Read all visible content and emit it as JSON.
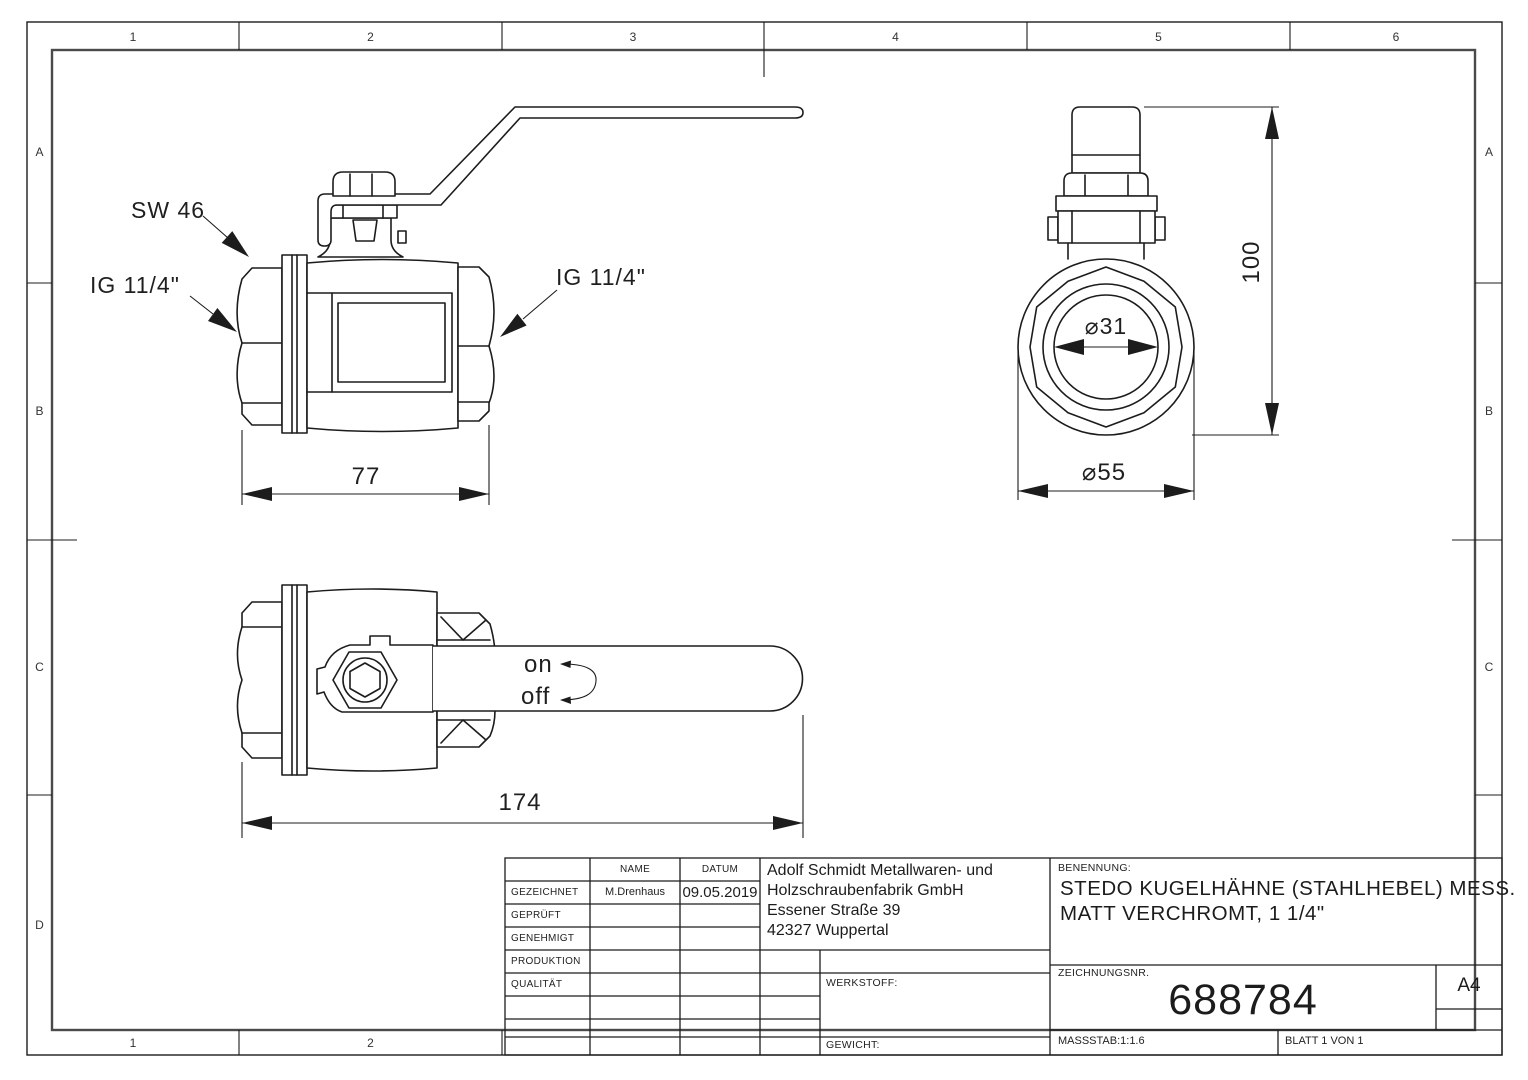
{
  "ruler": {
    "top": [
      "1",
      "2",
      "3",
      "4",
      "5",
      "6"
    ],
    "bottom": [
      "1",
      "2"
    ],
    "left": [
      "A",
      "B",
      "C",
      "D"
    ],
    "right": [
      "A",
      "B",
      "C"
    ]
  },
  "front_view": {
    "wrench_label": "SW 46",
    "thread_label_left": "IG 11/4\"",
    "thread_label_right": "IG 11/4\"",
    "width_dim": "77"
  },
  "end_view": {
    "height_dim": "100",
    "bore_dim": "⌀31",
    "outer_dim": "⌀55"
  },
  "top_view": {
    "length_dim": "174",
    "on_label": "on",
    "off_label": "off"
  },
  "title_block": {
    "name_header": "NAME",
    "date_header": "DATUM",
    "row_labels": {
      "drawn": "GEZEICHNET",
      "checked": "GEPRÜFT",
      "approved": "GENEHMIGT",
      "production": "PRODUKTION",
      "quality": "QUALITÄT"
    },
    "drawn_name": "M.Drenhaus",
    "drawn_date": "09.05.2019",
    "company": [
      "Adolf Schmidt Metallwaren- und",
      "Holzschraubenfabrik GmbH",
      "Essener Straße 39",
      "42327 Wuppertal"
    ],
    "material_label": "WERKSTOFF:",
    "weight_label": "GEWICHT:",
    "title_label": "BENENNUNG:",
    "title_lines": [
      "STEDO KUGELHÄHNE (STAHLHEBEL) MESS.",
      "MATT VERCHROMT, 1 1/4\""
    ],
    "drawing_no_label": "ZEICHNUNGSNR.",
    "drawing_no": "688784",
    "paper_format": "A4",
    "scale": "MASSSTAB:1:1.6",
    "sheet": "BLATT 1 VON 1"
  }
}
